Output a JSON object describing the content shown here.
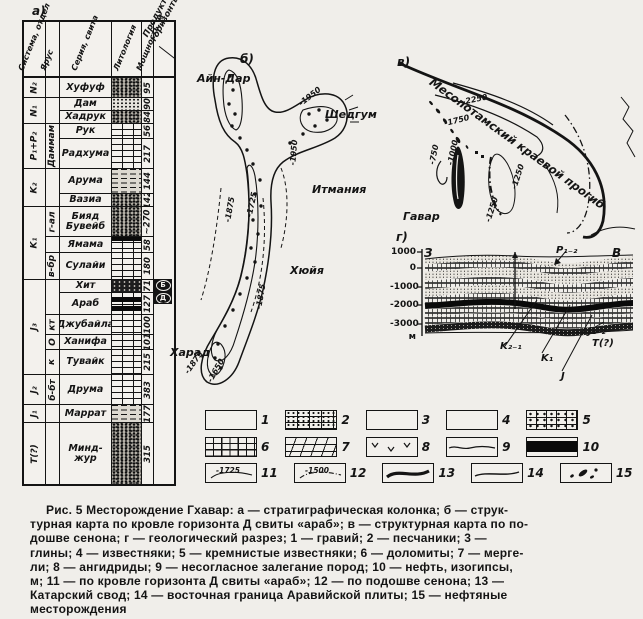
{
  "page": {
    "panel_a": "а)",
    "panel_b": "б)",
    "panel_v": "в)",
    "panel_g": "г)"
  },
  "strat": {
    "headers": {
      "system": "Система, отдел",
      "stage": "Ярус",
      "series": "Серия, свита",
      "lithology": "Литология",
      "thickness": "Мощность, м",
      "productive": "Продуктивные горизонты"
    },
    "groups": [
      "N₂",
      "N₁",
      "P₁+P₂",
      "K₂",
      "K₁",
      "J₃",
      "J₂",
      "J₁",
      "T(?)"
    ],
    "stages": [
      "Даммам",
      "г-ал",
      "в-бр",
      "кт",
      "О",
      "к",
      "б-бт"
    ],
    "rows": [
      {
        "name": "Хуфуф",
        "thickness": "95"
      },
      {
        "name": "Дам",
        "thickness": "90"
      },
      {
        "name": "Хадрук",
        "thickness": "84"
      },
      {
        "name": "Рук",
        "thickness": "56"
      },
      {
        "name": "Радху­ма",
        "thickness": "217"
      },
      {
        "name": "Арума",
        "thickness": "144"
      },
      {
        "name": "Вазиа",
        "thickness": "142"
      },
      {
        "name": "Бияд Бувейб",
        "thickness": "~270"
      },
      {
        "name": "Ямама",
        "thickness": "58"
      },
      {
        "name": "Сулайи",
        "thickness": "180"
      },
      {
        "name": "Хит",
        "thickness": "71"
      },
      {
        "name": "Араб",
        "thickness": "127"
      },
      {
        "name": "Джубайла",
        "thickness": "100"
      },
      {
        "name": "Ханифа",
        "thickness": "101"
      },
      {
        "name": "Тувайк",
        "thickness": "215"
      },
      {
        "name": "Друма",
        "thickness": "383"
      },
      {
        "name": "Маррат",
        "thickness": "177"
      },
      {
        "name": "Минд­жур",
        "thickness": "315"
      }
    ],
    "markers": [
      "Б",
      "Д"
    ]
  },
  "map_b": {
    "places": {
      "ain_dar": "Айн-Дар",
      "shedgum": "Шедгум",
      "itmania": "Итмания",
      "huyia": "Хюйя",
      "harad": "Харад"
    },
    "iso": [
      "-1950",
      "-1950",
      "-1875",
      "-1725",
      "-1875",
      "-1875",
      "-1650"
    ]
  },
  "map_v": {
    "trough": "Месопотамский краевой прогиб",
    "field": "Гавар",
    "iso": [
      "-2250",
      "-1750",
      "-750",
      "-1000",
      "-1250",
      "-1250"
    ]
  },
  "section": {
    "west": "З",
    "east": "В",
    "depths": [
      "1000",
      "0",
      "-1000",
      "-2000",
      "-3000"
    ],
    "unit": "м",
    "labels": {
      "p": "P₁₋₂",
      "k21": "K₂₋₁",
      "k1": "K₁",
      "j": "J",
      "j12": "J₁₋₂",
      "t": "T(?)"
    }
  },
  "legend": {
    "items": [
      {
        "num": "1"
      },
      {
        "num": "2"
      },
      {
        "num": "3"
      },
      {
        "num": "4"
      },
      {
        "num": "5"
      },
      {
        "num": "6"
      },
      {
        "num": "7"
      },
      {
        "num": "8"
      },
      {
        "num": "9"
      },
      {
        "num": "10"
      },
      {
        "num": "11"
      },
      {
        "num": "12"
      },
      {
        "num": "13"
      },
      {
        "num": "14"
      },
      {
        "num": "15"
      }
    ],
    "iso_arab": "-1725",
    "iso_senon": "-1500"
  },
  "caption": {
    "lines": [
      "Рис. 5   Месторождение Гхавар: а — стратиграфическая колонка; б — струк-",
      "турная карта по кровле горизонта Д свиты «араб»; в — структурная карта по по-",
      "дошве сенона; г — геологический разрез; 1 — гравий; 2 — песчаники; 3 —",
      "глины; 4 — известняки; 5 — кремнистые известняки; 6 — доломиты; 7 — мерге-",
      "ли; 8 — ангидриды; 9 — несогласное залегание пород; 10 — нефть, изогипсы,",
      "м; 11 — по кровле горизонта Д свиты «араб»; 12 — по подошве сенона; 13 —",
      "Катарский свод; 14 — восточная граница Аравийской плиты; 15 — нефтяные",
      "месторождения"
    ]
  }
}
